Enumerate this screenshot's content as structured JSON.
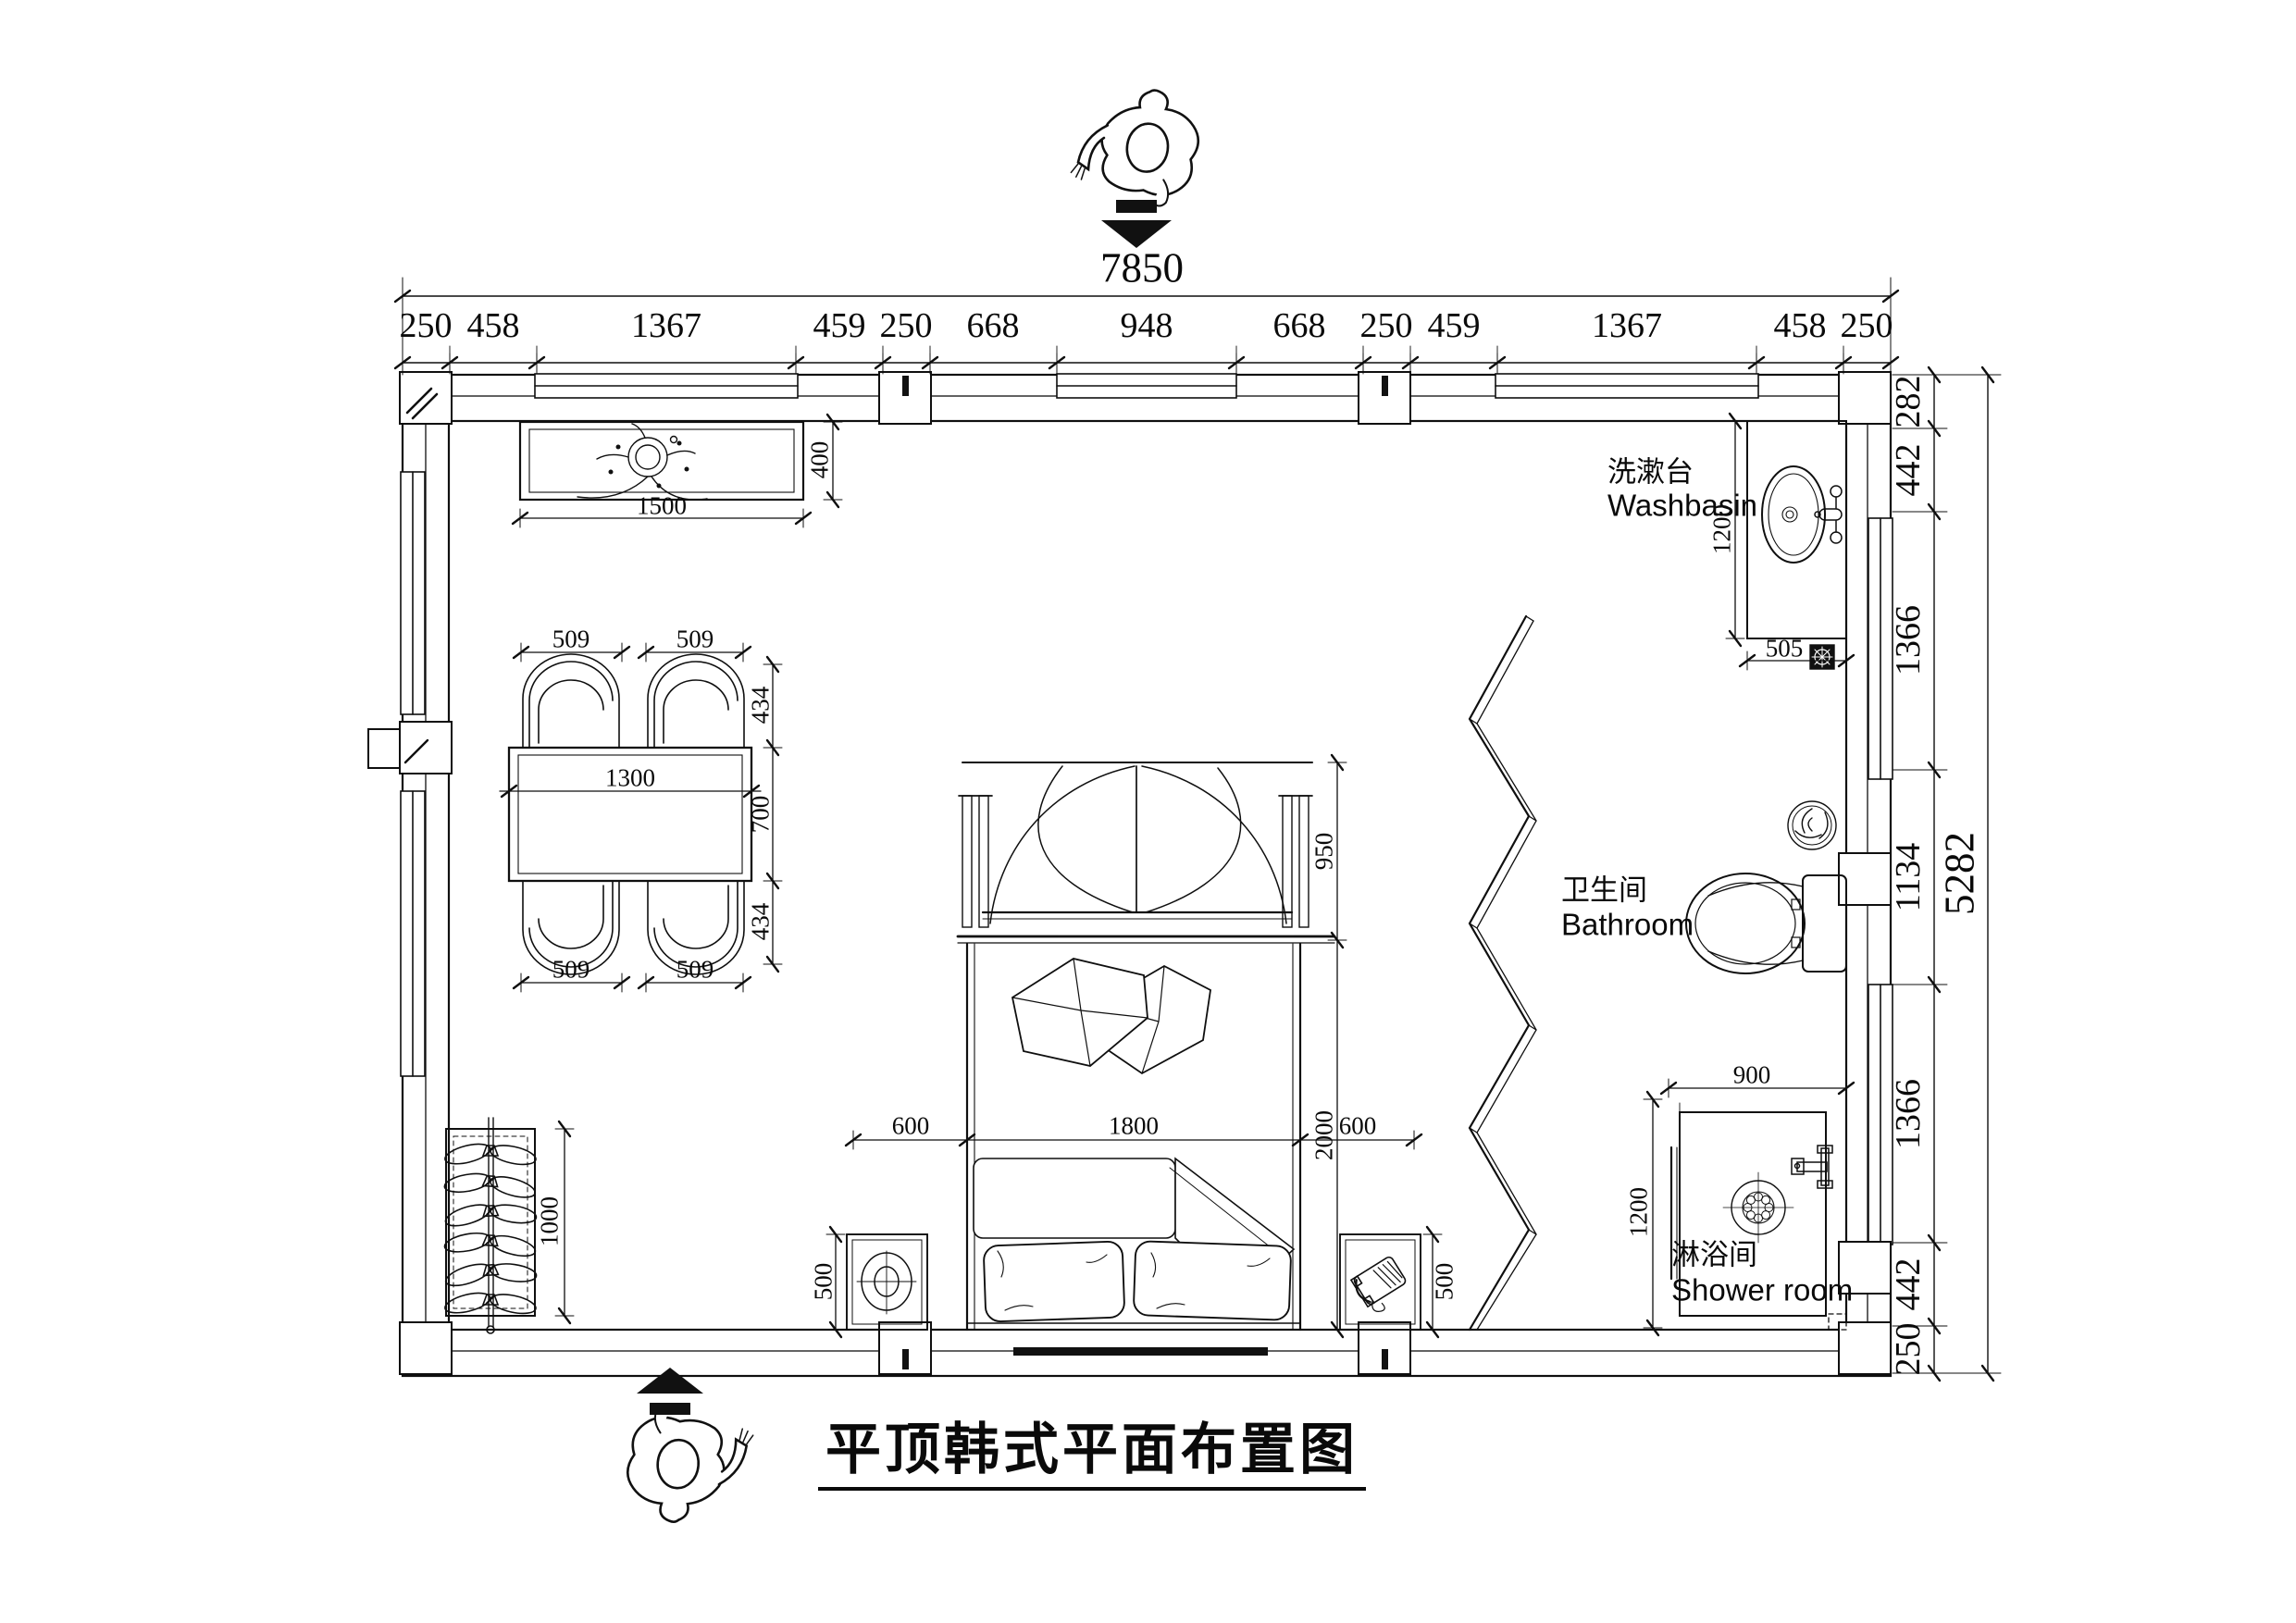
{
  "title": "平顶韩式平面布置图",
  "top_chain": {
    "total": "7850",
    "segments": [
      "250",
      "458",
      "1367",
      "459",
      "250",
      "668",
      "948",
      "668",
      "250",
      "459",
      "1367",
      "458",
      "250"
    ]
  },
  "right_chain": {
    "total": "5282",
    "segments": [
      "282",
      "442",
      "1366",
      "1134",
      "1366",
      "442",
      "250"
    ]
  },
  "labels": {
    "washbasin_cn": "洗漱台",
    "washbasin_en": "Washbasin",
    "bathroom_cn": "卫生间",
    "bathroom_en": "Bathroom",
    "shower_cn": "淋浴间",
    "shower_en": "Shower room"
  },
  "dims": {
    "tv_width": "1500",
    "tv_depth": "400",
    "chair_tl": "509",
    "chair_tr": "509",
    "chair_bl": "509",
    "chair_br": "509",
    "table_width": "1300",
    "dining_back_top": "434",
    "table_depth": "700",
    "dining_back_bottom": "434",
    "canopy_depth": "950",
    "bed_width": "1800",
    "bed_length": "2000",
    "bed_side_left": "600",
    "bed_side_right": "600",
    "nightstand_left": "500",
    "nightstand_right": "500",
    "wardrobe_length": "1000",
    "washbasin_depth": "1200",
    "washbasin_width": "505",
    "shower_width": "900",
    "shower_depth": "1200"
  }
}
